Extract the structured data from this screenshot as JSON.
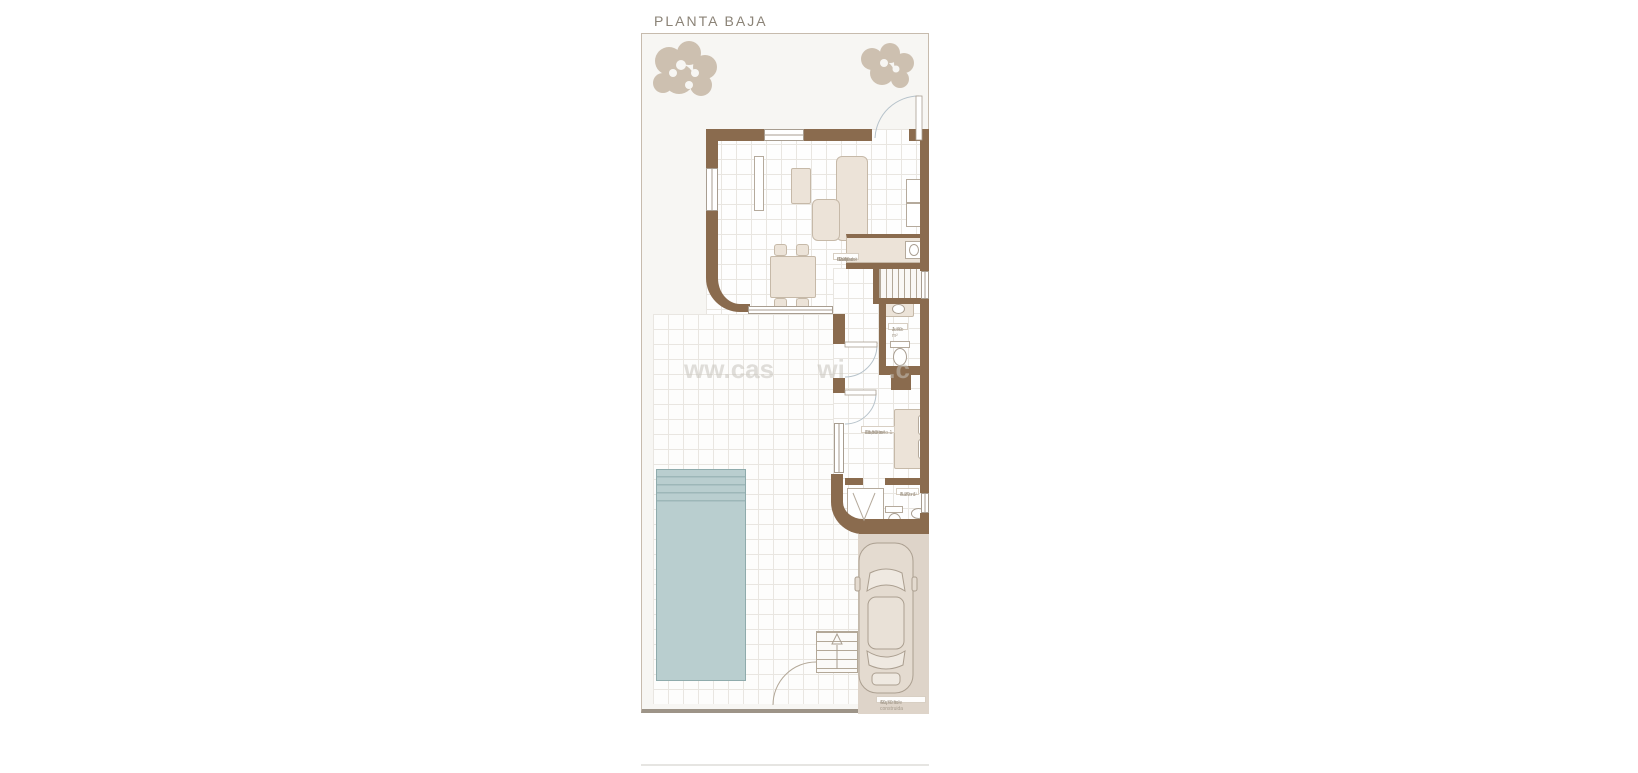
{
  "title": "PLANTA BAJA",
  "watermark": "ww.cas      wi      .c",
  "rooms": {
    "living": {
      "line1": "Salón",
      "line2": "Comedor",
      "line3": "Cocina",
      "line4": "Hall",
      "area": "32.40 m²"
    },
    "aseo": {
      "line1": "Aseo",
      "area": "1.70 m²"
    },
    "bedroom": {
      "line1": "Dormitorio 1",
      "line2": "en suite",
      "area": "13,50 m²"
    },
    "bath": {
      "line1": "Baño 1",
      "area": "4.20 m²"
    },
    "built": {
      "line1": "Superficie construida",
      "area": "40,70 m²"
    }
  },
  "colors": {
    "wall": "#8a6b4e",
    "pool": "#b9cecf",
    "plot_fill": "#f7f6f3",
    "driveway": "#ded4c9",
    "tree": "#cdc0b0",
    "furniture": "#ece3d8",
    "label_text": "#a79d8f",
    "title_text": "#8b8377"
  }
}
